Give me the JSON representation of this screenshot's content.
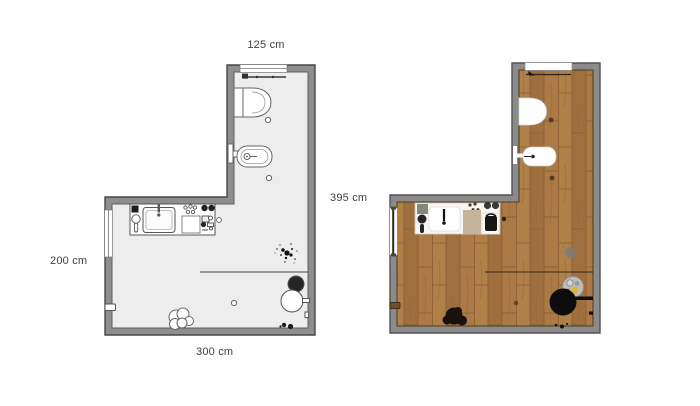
{
  "dimensions": {
    "top": "125 cm",
    "right": "395 cm",
    "left": "200 cm",
    "bottom": "300 cm"
  },
  "colors": {
    "wall": "#8e8e8e",
    "wall_outline": "#474747",
    "floor_plain": "#ededed",
    "wood_base": "#a87744",
    "wood_light": "#b08049",
    "wood_dark": "#9f6f3e",
    "wood_seam": "#8a5c31",
    "label_text": "#3f3f3f"
  },
  "plans": [
    {
      "id": "plan-schematic",
      "description": "2D schematic bathroom floor plan",
      "fixtures": [
        "window-top",
        "radiator",
        "toilet",
        "bidet",
        "vanity-sink",
        "window-left",
        "door-stop",
        "partition-line",
        "plant-splatter",
        "side-table",
        "stool",
        "laundry-pile",
        "floor-drain"
      ]
    },
    {
      "id": "plan-textured",
      "description": "Textured bathroom floor plan with wood floor",
      "fixtures": [
        "window-top",
        "toilet",
        "bidet",
        "vanity-sink",
        "window-left",
        "door-stop",
        "partition-line",
        "plant-splatter",
        "bowl",
        "stool",
        "laundry-pile",
        "floor-drain"
      ]
    }
  ]
}
